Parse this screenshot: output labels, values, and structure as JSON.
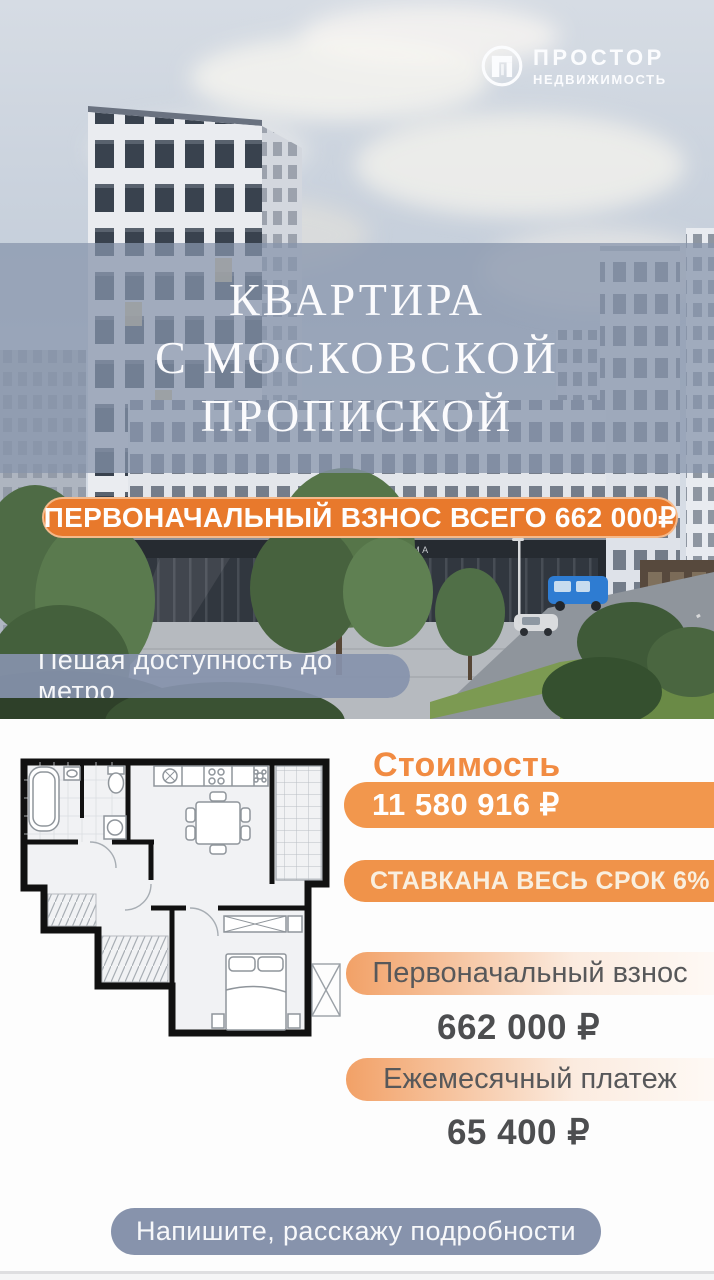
{
  "logo": {
    "title": "ПРОСТОР",
    "subtitle": "НЕДВИЖИМОСТЬ"
  },
  "hero": {
    "title_lines": [
      "КВАРТИРА",
      "С МОСКОВСКОЙ",
      "ПРОПИСКОЙ"
    ],
    "banner": "ПЕРВОНАЧАЛЬНЫЙ ВЗНОС ВСЕГО 662 000₽",
    "metro_badge": "Пешая доступность до метро",
    "storefront_sign": "ТОВАРЫ ДЛЯ ДОМА"
  },
  "details": {
    "price_heading": "Стоимость",
    "price_value": "11 580 916 ₽",
    "rate_badge": "СТАВКАНА ВЕСЬ СРОК 6%",
    "items": [
      {
        "label": "Первоначальный взнос",
        "value": "662 000 ₽"
      },
      {
        "label": "Ежемесячный платеж",
        "value": "65 400 ₽"
      }
    ],
    "cta": "Напишите, расскажу подробности"
  },
  "icons": {
    "logo": "doorframe-in-circle"
  },
  "colors": {
    "accent-orange": "#E8792C",
    "pill-orange": "#F2974D",
    "rate-orange": "#F0934A",
    "heading-orange": "#F18B42",
    "grad-start": "#F2A167",
    "badge-gray": "#8793AC",
    "overlay-blue": "#8794AB",
    "text-dark": "#4D4E50",
    "label-gray": "#57585A"
  }
}
